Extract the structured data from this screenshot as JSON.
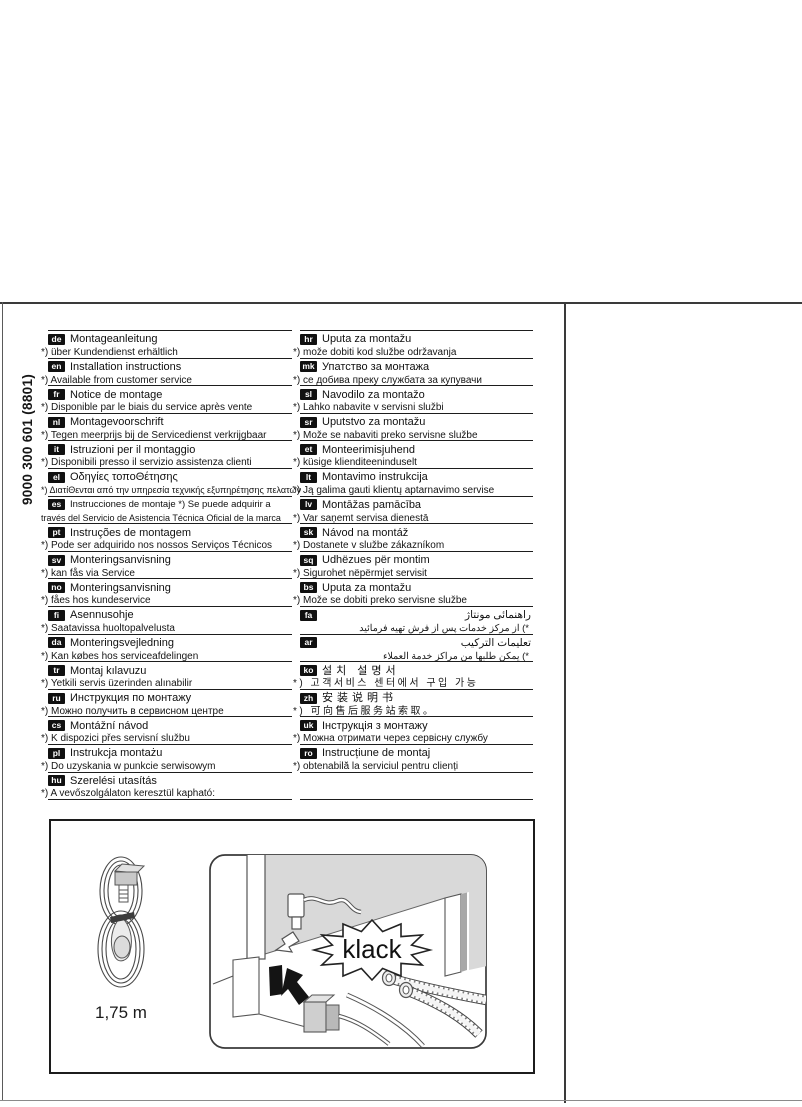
{
  "page": {
    "background": "#ffffff",
    "product_code": "9000 300 601  (8801)",
    "illustration": {
      "cable_length_label": "1,75 m",
      "callout": "klack"
    }
  },
  "languages": {
    "left": [
      {
        "code": "de",
        "title": "Montageanleitung",
        "footnote": "*) über Kundendienst erhältlich"
      },
      {
        "code": "en",
        "title": "Installation instructions",
        "footnote": "*) Available from customer service"
      },
      {
        "code": "fr",
        "title": "Notice de montage",
        "footnote": "*) Disponible par le biais du service après vente"
      },
      {
        "code": "nl",
        "title": "Montagevoorschrift",
        "footnote": "*) Tegen meerprijs bij de Servicedienst verkrijgbaar"
      },
      {
        "code": "it",
        "title": "Istruzioni per il montaggio",
        "footnote": "*) Disponibili presso il servizio assistenza clienti"
      },
      {
        "code": "el",
        "title": "Οδηγίες τοποΘέτησης",
        "footnote": "*) ΔιατίΘενται από την υπηρεσία τεχνικής εξυπηρέτησης πελατών",
        "small_footnote": true
      },
      {
        "code": "es",
        "title": "Instrucciones de montaje    *) Se puede adquirir a",
        "footnote": "través del Servicio de Asistencia Técnica Oficial de la marca",
        "small_title": true,
        "small_footnote": true
      },
      {
        "code": "pt",
        "title": "Instruções de montagem",
        "footnote": "*) Pode ser adquirido nos nossos Serviços Técnicos"
      },
      {
        "code": "sv",
        "title": "Monteringsanvisning",
        "footnote": "*) kan fås via Service"
      },
      {
        "code": "no",
        "title": "Monteringsanvisning",
        "footnote": "*) fåes hos kundeservice"
      },
      {
        "code": "fi",
        "title": "Asennusohje",
        "footnote": "*) Saatavissa huoltopalvelusta"
      },
      {
        "code": "da",
        "title": "Monteringsvejledning",
        "footnote": "*) Kan købes hos serviceafdelingen"
      },
      {
        "code": "tr",
        "title": "Montaj kılavuzu",
        "footnote": "*) Yetkili servis üzerinden alınabilir"
      },
      {
        "code": "ru",
        "title": "Инструкция по монтажу",
        "footnote": "*) Можно получить в сервисном центре"
      },
      {
        "code": "cs",
        "title": "Montážní návod",
        "footnote": "*) K dispozici přes servisní službu"
      },
      {
        "code": "pl",
        "title": "Instrukcja montażu",
        "footnote": "*) Do uzyskania w punkcie serwisowym"
      },
      {
        "code": "hu",
        "title": "Szerelési utasítás",
        "footnote": "*) A vevőszolgálaton keresztül kapható:"
      }
    ],
    "right": [
      {
        "code": "hr",
        "title": "Uputa za montažu",
        "footnote": "*) može dobiti kod službe održavanja"
      },
      {
        "code": "mk",
        "title": "Упатство за монтажа",
        "footnote": "*) се добива преку службата за купувачи"
      },
      {
        "code": "sl",
        "title": "Navodilo za montažo",
        "footnote": "*) Lahko nabavite v servisni službi"
      },
      {
        "code": "sr",
        "title": "Uputstvo za montažu",
        "footnote": "*) Može se nabaviti preko servisne službe"
      },
      {
        "code": "et",
        "title": "Monteerimisjuhend",
        "footnote": "*) küsige klienditeeninduselt"
      },
      {
        "code": "lt",
        "title": "Montavimo instrukcija",
        "footnote": "*) Ją galima gauti klientų aptarnavimo servise"
      },
      {
        "code": "lv",
        "title": "Montāžas pamācība",
        "footnote": "*) Var saņemt servisa dienestā"
      },
      {
        "code": "sk",
        "title": "Návod na montáž",
        "footnote": "*) Dostanete v službe zákazníkom"
      },
      {
        "code": "sq",
        "title": "Udhëzues për montim",
        "footnote": "*) Sigurohet nëpërmjet servisit"
      },
      {
        "code": "bs",
        "title": "Uputa za montažu",
        "footnote": "*) Može se dobiti preko servisne službe"
      },
      {
        "code": "fa",
        "title": "راهنمائی مونتاژ",
        "footnote": "*) از مرکز خدمات پس از فرش تهیه فرمائید",
        "rtl": true
      },
      {
        "code": "ar",
        "title": "تعليمات التركيب",
        "footnote": "*) يمكن طلبها من مراكز خدمة العملاء",
        "rtl": true
      },
      {
        "code": "ko",
        "title": "설치 설명서",
        "footnote": "*) 고객서비스 센터에서 구입 가능",
        "cjk": true
      },
      {
        "code": "zh",
        "title": "安装说明书",
        "footnote": "*) 可向售后服务站索取。",
        "cjk": true
      },
      {
        "code": "uk",
        "title": "Інструкція з монтажу",
        "footnote": "*) Можна отримати через сервісну службу"
      },
      {
        "code": "ro",
        "title": "Instrucțiune de montaj",
        "footnote": "*) obtenabilă la serviciul pentru clienți"
      },
      {
        "empty": true
      }
    ]
  }
}
